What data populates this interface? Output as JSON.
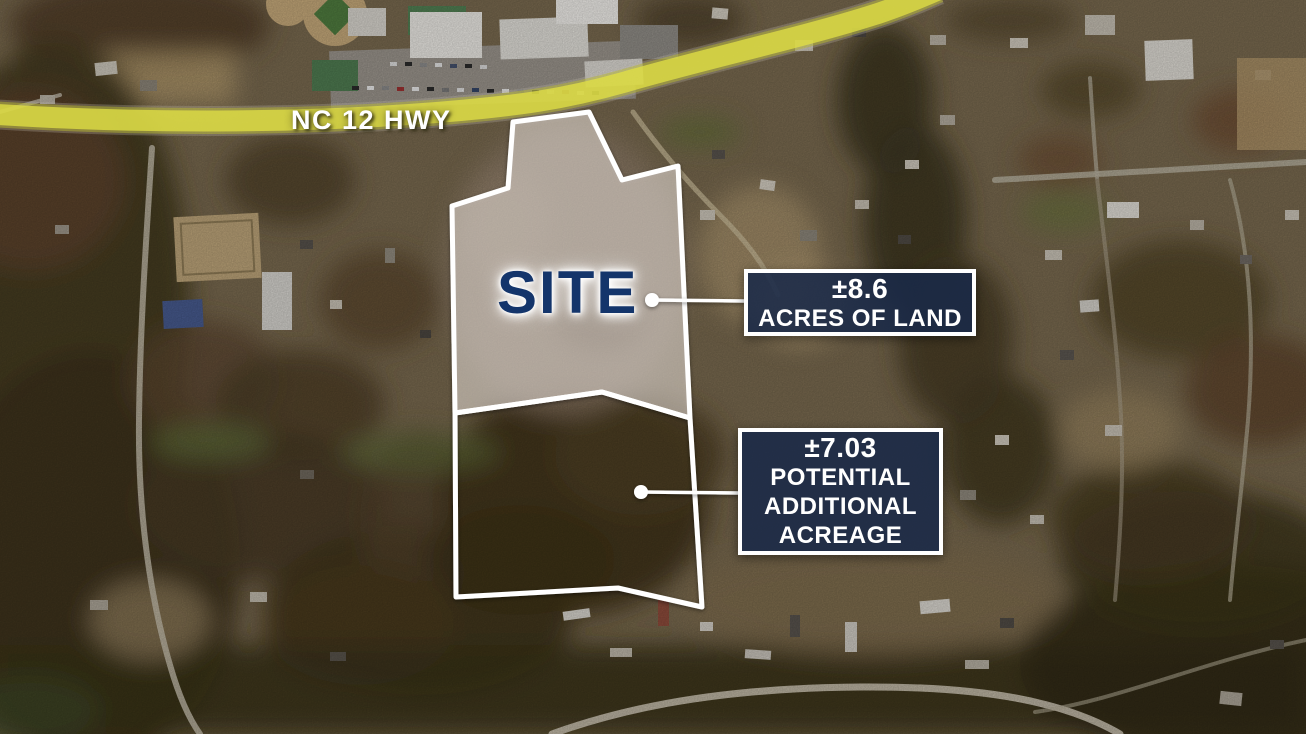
{
  "map_overlay": {
    "highway_label": "NC 12 HWY",
    "site_label": "SITE",
    "callout_acres": {
      "value": "±8.6",
      "label": "ACRES OF LAND"
    },
    "callout_additional": {
      "value": "±7.03",
      "lines": [
        "POTENTIAL",
        "ADDITIONAL",
        "ACREAGE"
      ]
    },
    "colors": {
      "highway_highlight": "#e0df45",
      "site_text": "#14356b",
      "boundary_outline": "#ffffff",
      "callout_background": "#192948",
      "callout_border": "#ffffff",
      "callout_text": "#ffffff"
    }
  }
}
